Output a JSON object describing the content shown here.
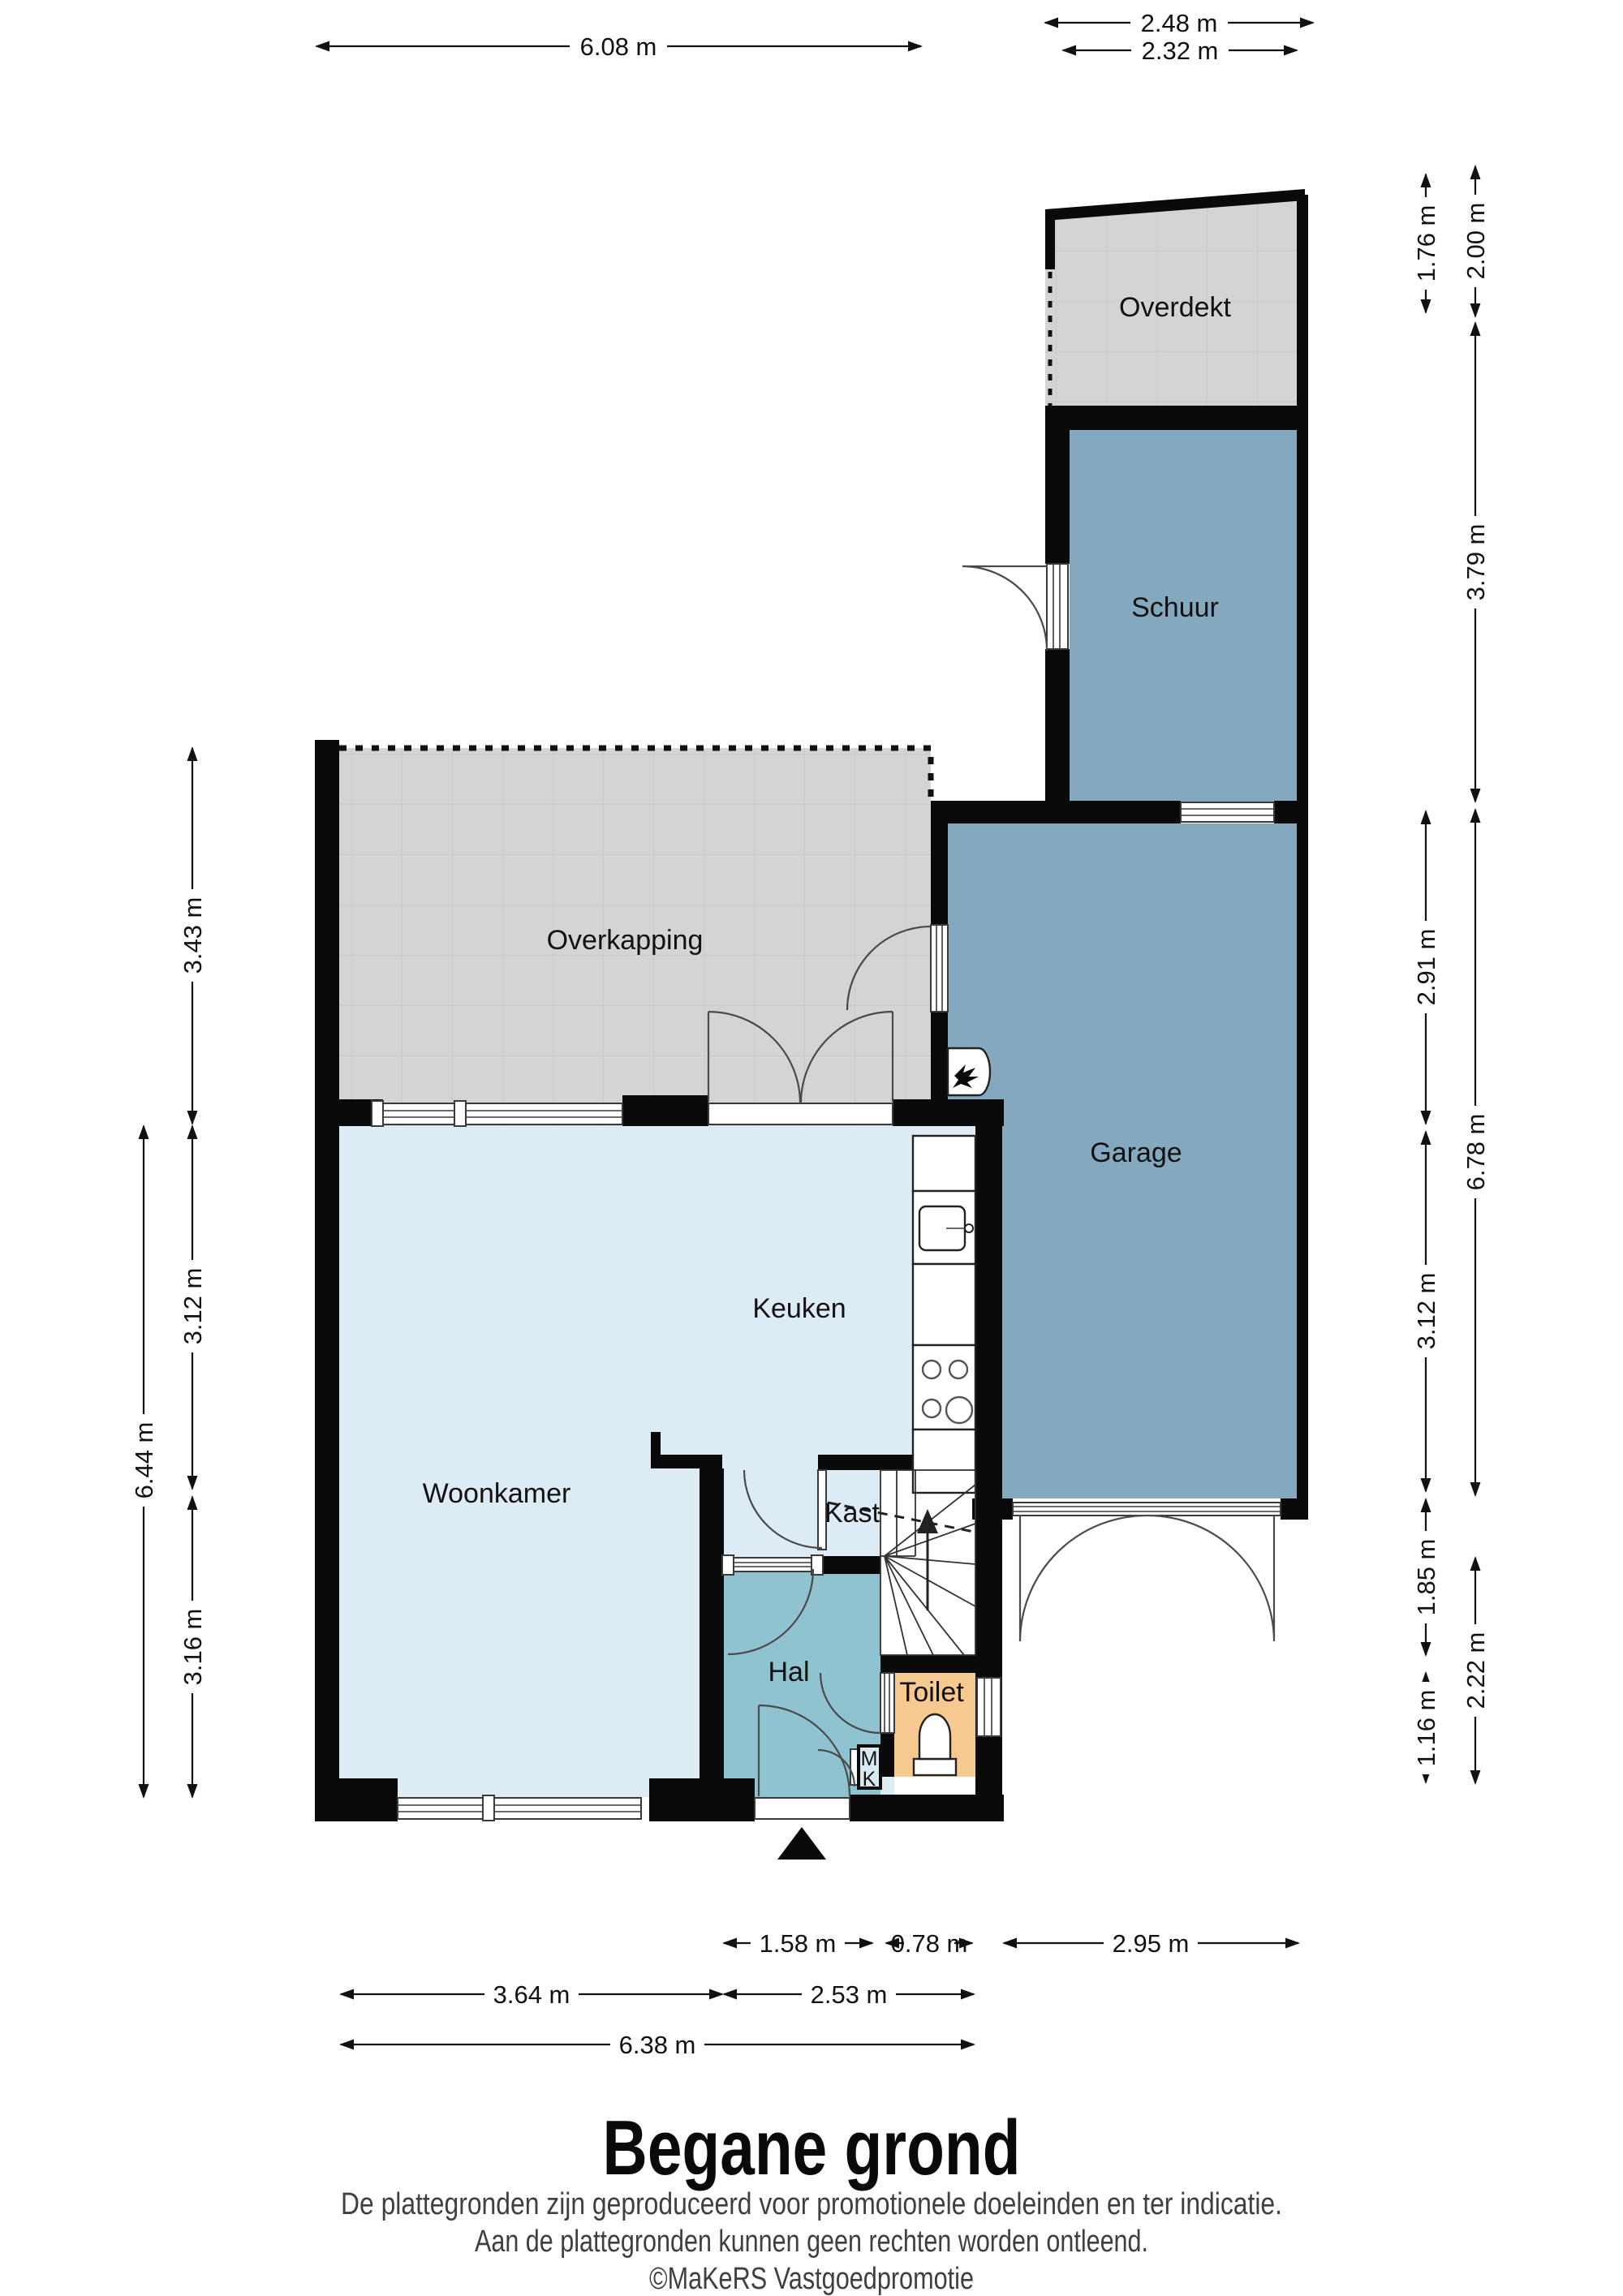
{
  "plan": {
    "title": "Begane grond",
    "disclaimer": [
      "De plattegronden zijn geproduceerd voor promotionele doeleinden en ter indicatie.",
      "Aan de plattegronden kunnen geen rechten worden ontleend.",
      "©MaKeRS Vastgoedpromotie"
    ],
    "rooms": {
      "overdekt": "Overdekt",
      "schuur": "Schuur",
      "overkapping": "Overkapping",
      "garage": "Garage",
      "keuken": "Keuken",
      "woonkamer": "Woonkamer",
      "kast": "Kast",
      "hal": "Hal",
      "toilet": "Toilet",
      "meterkast_m": "M",
      "meterkast_k": "K"
    },
    "dimensions": {
      "top": {
        "overkapping_width": "6.08 m",
        "overdekt_width_outer": "2.48 m",
        "overdekt_width_inner": "2.32 m"
      },
      "right_inner": {
        "overdekt_depth": "1.76 m",
        "garage_upper": "2.91 m",
        "garage_lower": "3.12 m",
        "entry_zone": "1.85 m",
        "toilet_depth": "1.16 m"
      },
      "right_outer": {
        "overdekt_total": "2.00 m",
        "schuur_depth": "3.79 m",
        "garage_total": "6.78 m",
        "rear_zone": "2.22 m"
      },
      "left": {
        "overkapping_depth": "3.43 m",
        "woonkamer_total": "6.44 m",
        "woonkamer_upper": "3.12 m",
        "woonkamer_lower": "3.16 m"
      },
      "bottom": {
        "hal_width": "1.58 m",
        "stair_width": "0.78 m",
        "garage_width": "2.95 m",
        "woonkamer_width": "3.64 m",
        "hal_zone_width": "2.53 m",
        "house_width": "6.38 m"
      }
    },
    "colors": {
      "wall": "#0a0a0a",
      "covered_area": "#d4d4d4",
      "outbuilding": "#84a9bf",
      "living": "#dcebf4",
      "hall": "#8fc3cf",
      "toilet": "#f5c98f"
    }
  }
}
